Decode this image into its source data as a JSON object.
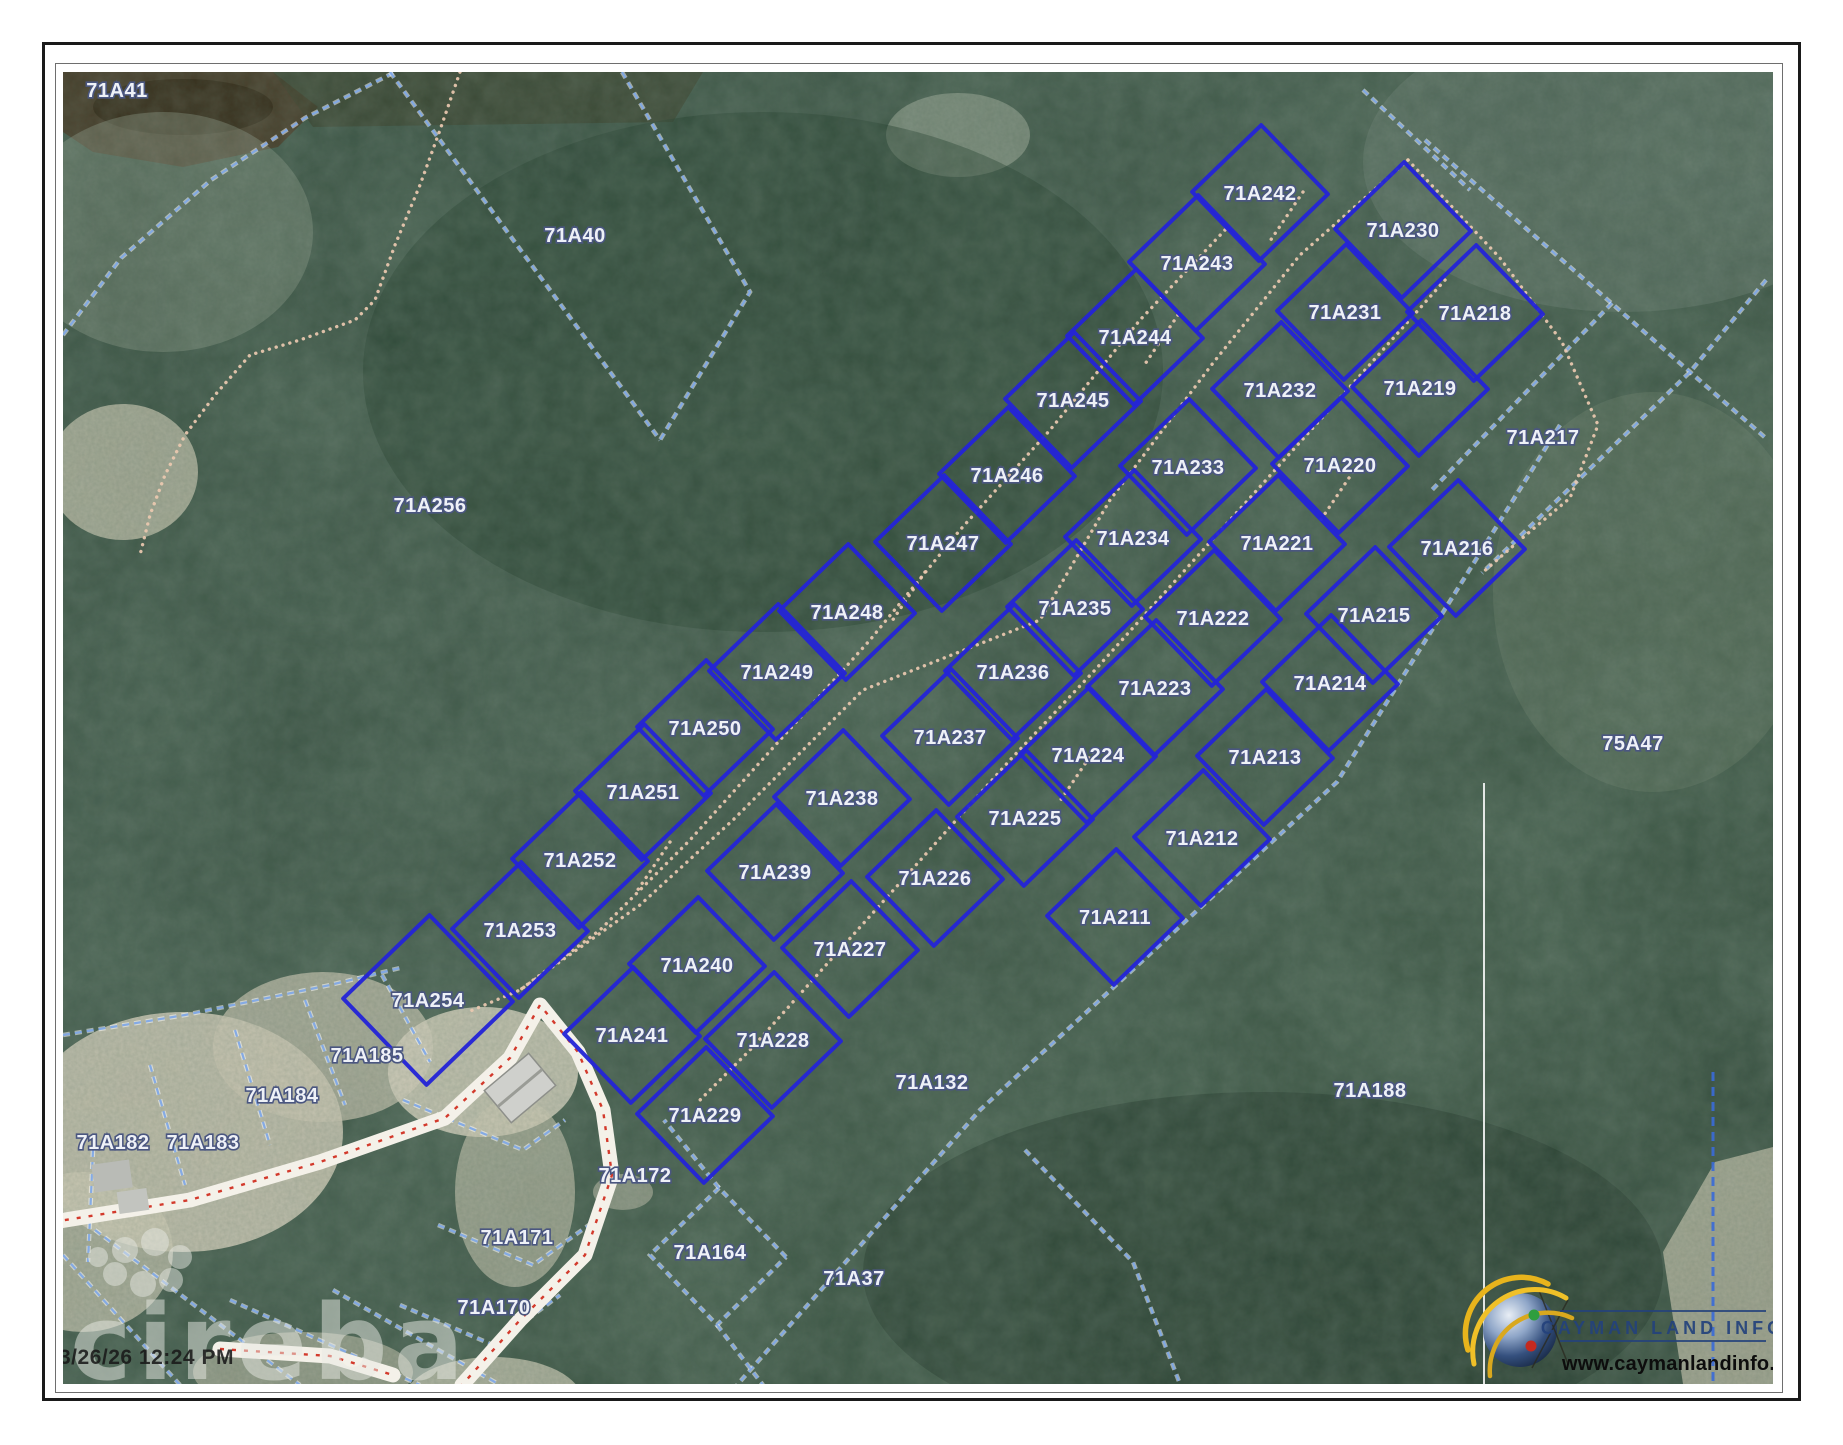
{
  "map": {
    "width": 1710,
    "height": 1312,
    "timestamp": "3/26/26 12:24 PM",
    "watermark": "cireba",
    "logo": {
      "title": "CAYMAN LAND INFO",
      "url": "www.caymanlandinfo.ky"
    },
    "colors": {
      "parcel_blue": "#2424d6",
      "boundary_blue": "#7fa8e6",
      "trail_tan": "#ecc9b0",
      "road_red": "#cf2617",
      "road_white": "#f4f1e9",
      "label_fill": "#eef1f7",
      "label_stroke": "#4a5680",
      "logo_navy": "#24427c",
      "forest_dark": "#2c4336",
      "sand": "#d2cdb8"
    },
    "parcels": [
      {
        "id": "71A242",
        "x": 1197,
        "y": 121
      },
      {
        "id": "71A243",
        "x": 1134,
        "y": 191
      },
      {
        "id": "71A244",
        "x": 1072,
        "y": 265
      },
      {
        "id": "71A245",
        "x": 1010,
        "y": 328
      },
      {
        "id": "71A246",
        "x": 944,
        "y": 403
      },
      {
        "id": "71A247",
        "x": 880,
        "y": 471
      },
      {
        "id": "71A248",
        "x": 784,
        "y": 540
      },
      {
        "id": "71A249",
        "x": 714,
        "y": 600
      },
      {
        "id": "71A250",
        "x": 642,
        "y": 656
      },
      {
        "id": "71A251",
        "x": 580,
        "y": 720
      },
      {
        "id": "71A252",
        "x": 517,
        "y": 788
      },
      {
        "id": "71A253",
        "x": 457,
        "y": 858
      },
      {
        "id": "71A254",
        "x": 365,
        "y": 928,
        "s": 120
      },
      {
        "id": "71A233",
        "x": 1125,
        "y": 395
      },
      {
        "id": "71A234",
        "x": 1070,
        "y": 466
      },
      {
        "id": "71A235",
        "x": 1012,
        "y": 536
      },
      {
        "id": "71A236",
        "x": 950,
        "y": 600
      },
      {
        "id": "71A237",
        "x": 887,
        "y": 665
      },
      {
        "id": "71A238",
        "x": 779,
        "y": 726
      },
      {
        "id": "71A239",
        "x": 712,
        "y": 800
      },
      {
        "id": "71A240",
        "x": 634,
        "y": 893
      },
      {
        "id": "71A241",
        "x": 569,
        "y": 963
      },
      {
        "id": "71A230",
        "x": 1340,
        "y": 158
      },
      {
        "id": "71A231",
        "x": 1282,
        "y": 240
      },
      {
        "id": "71A232",
        "x": 1217,
        "y": 318
      },
      {
        "id": "71A218",
        "x": 1412,
        "y": 241
      },
      {
        "id": "71A219",
        "x": 1357,
        "y": 316
      },
      {
        "id": "71A220",
        "x": 1277,
        "y": 393
      },
      {
        "id": "71A221",
        "x": 1214,
        "y": 471
      },
      {
        "id": "71A222",
        "x": 1150,
        "y": 546
      },
      {
        "id": "71A223",
        "x": 1092,
        "y": 616
      },
      {
        "id": "71A224",
        "x": 1025,
        "y": 683
      },
      {
        "id": "71A225",
        "x": 962,
        "y": 746
      },
      {
        "id": "71A226",
        "x": 872,
        "y": 806
      },
      {
        "id": "71A227",
        "x": 787,
        "y": 877
      },
      {
        "id": "71A228",
        "x": 710,
        "y": 968
      },
      {
        "id": "71A229",
        "x": 642,
        "y": 1043
      },
      {
        "id": "71A216",
        "x": 1394,
        "y": 476
      },
      {
        "id": "71A215",
        "x": 1311,
        "y": 543
      },
      {
        "id": "71A214",
        "x": 1267,
        "y": 611
      },
      {
        "id": "71A213",
        "x": 1202,
        "y": 685
      },
      {
        "id": "71A212",
        "x": 1139,
        "y": 766
      },
      {
        "id": "71A211",
        "x": 1052,
        "y": 845
      }
    ],
    "area_labels": [
      {
        "id": "71A41",
        "x": 54,
        "y": 18
      },
      {
        "id": "71A40",
        "x": 512,
        "y": 163
      },
      {
        "id": "71A256",
        "x": 367,
        "y": 433
      },
      {
        "id": "75A47",
        "x": 1570,
        "y": 671
      },
      {
        "id": "71A188",
        "x": 1307,
        "y": 1018
      },
      {
        "id": "71A132",
        "x": 869,
        "y": 1010
      },
      {
        "id": "71A37",
        "x": 791,
        "y": 1206
      },
      {
        "id": "71A185",
        "x": 304,
        "y": 983
      },
      {
        "id": "71A184",
        "x": 219,
        "y": 1023
      },
      {
        "id": "71A183",
        "x": 140,
        "y": 1070
      },
      {
        "id": "71A182",
        "x": 50,
        "y": 1070
      },
      {
        "id": "71A172",
        "x": 572,
        "y": 1103
      },
      {
        "id": "71A171",
        "x": 454,
        "y": 1165
      },
      {
        "id": "71A170",
        "x": 431,
        "y": 1235
      },
      {
        "id": "71A164",
        "x": 647,
        "y": 1180
      },
      {
        "id": "71A217",
        "x": 1480,
        "y": 365
      }
    ],
    "boundary_lines": [
      {
        "name": "71A41-arc",
        "pts": [
          [
            0,
            263
          ],
          [
            58,
            186
          ],
          [
            148,
            108
          ],
          [
            242,
            46
          ],
          [
            332,
            0
          ]
        ]
      },
      {
        "name": "71A40-west",
        "pts": [
          [
            327,
            0
          ],
          [
            597,
            368
          ]
        ]
      },
      {
        "name": "71A40-east",
        "pts": [
          [
            559,
            0
          ],
          [
            687,
            220
          ],
          [
            597,
            368
          ]
        ]
      },
      {
        "name": "ne-diagonal",
        "pts": [
          [
            1362,
            68
          ],
          [
            1627,
            300
          ],
          [
            1705,
            368
          ]
        ]
      },
      {
        "name": "ne-cross",
        "pts": [
          [
            1703,
            208
          ],
          [
            1627,
            300
          ],
          [
            1419,
            501
          ]
        ]
      },
      {
        "name": "217-ne-edge",
        "pts": [
          [
            1549,
            231
          ],
          [
            1367,
            420
          ]
        ]
      },
      {
        "name": "subdivision-se-boundary",
        "pts": [
          [
            1497,
            353
          ],
          [
            1274,
            710
          ],
          [
            917,
            1038
          ],
          [
            674,
            1313
          ]
        ]
      },
      {
        "name": "132-188-divider",
        "pts": [
          [
            962,
            1078
          ],
          [
            1070,
            1190
          ],
          [
            1117,
            1312
          ]
        ]
      },
      {
        "name": "ne-230-edge",
        "pts": [
          [
            1300,
            18
          ],
          [
            1407,
            118
          ]
        ]
      },
      {
        "name": "sw-lots-north",
        "pts": [
          [
            0,
            963
          ],
          [
            122,
            943
          ],
          [
            267,
            913
          ],
          [
            337,
            896
          ]
        ]
      },
      {
        "name": "182-183-divider",
        "pts": [
          [
            87,
            993
          ],
          [
            122,
            1113
          ]
        ]
      },
      {
        "name": "183-184-divider",
        "pts": [
          [
            172,
            958
          ],
          [
            207,
            1073
          ]
        ]
      },
      {
        "name": "184-185-divider",
        "pts": [
          [
            242,
            928
          ],
          [
            282,
            1033
          ]
        ]
      },
      {
        "name": "185-east-edge",
        "pts": [
          [
            319,
            903
          ],
          [
            367,
            990
          ]
        ]
      },
      {
        "name": "sw-corner-1",
        "pts": [
          [
            0,
            1183
          ],
          [
            117,
            1313
          ]
        ]
      },
      {
        "name": "sw-corner-2",
        "pts": [
          [
            32,
            1158
          ],
          [
            237,
            1313
          ]
        ]
      },
      {
        "name": "sw-corner-3",
        "pts": [
          [
            167,
            1228
          ],
          [
            357,
            1313
          ]
        ]
      },
      {
        "name": "sw-corner-4",
        "pts": [
          [
            270,
            1218
          ],
          [
            437,
            1313
          ]
        ]
      },
      {
        "name": "172-edges",
        "pts": [
          [
            340,
            1028
          ],
          [
            460,
            1078
          ],
          [
            502,
            1048
          ]
        ]
      },
      {
        "name": "171-edges",
        "pts": [
          [
            375,
            1153
          ],
          [
            470,
            1193
          ],
          [
            540,
            1143
          ]
        ]
      },
      {
        "name": "170-edges",
        "pts": [
          [
            337,
            1233
          ],
          [
            430,
            1273
          ],
          [
            497,
            1223
          ]
        ]
      },
      {
        "name": "164-parcel",
        "pts": [
          [
            723,
            1185
          ],
          [
            656,
            1116
          ],
          [
            587,
            1183
          ],
          [
            654,
            1253
          ],
          [
            723,
            1185
          ]
        ]
      },
      {
        "name": "37-west-edge",
        "pts": [
          [
            654,
            1253
          ],
          [
            700,
            1313
          ]
        ]
      },
      {
        "name": "164-north-tie",
        "pts": [
          [
            656,
            1116
          ],
          [
            601,
            1048
          ]
        ]
      },
      {
        "name": "left-edge-divider",
        "pts": [
          [
            30,
            1078
          ],
          [
            25,
            1190
          ]
        ]
      }
    ],
    "trails": [
      {
        "name": "central-track",
        "pts": [
          [
            1345,
            88
          ],
          [
            1237,
            183
          ],
          [
            1150,
            291
          ],
          [
            1047,
            428
          ],
          [
            977,
            548
          ],
          [
            800,
            618
          ],
          [
            670,
            748
          ],
          [
            577,
            833
          ],
          [
            457,
            918
          ],
          [
            405,
            940
          ]
        ]
      },
      {
        "name": "ne-branch-track",
        "pts": [
          [
            1345,
            88
          ],
          [
            1437,
            186
          ],
          [
            1499,
            270
          ],
          [
            1535,
            353
          ],
          [
            1507,
            426
          ],
          [
            1457,
            468
          ],
          [
            1419,
            501
          ]
        ]
      },
      {
        "name": "northwest-trail",
        "pts": [
          [
            397,
            0
          ],
          [
            377,
            58
          ],
          [
            357,
            113
          ],
          [
            332,
            173
          ],
          [
            312,
            228
          ],
          [
            292,
            248
          ],
          [
            237,
            268
          ],
          [
            187,
            283
          ],
          [
            152,
            323
          ],
          [
            122,
            363
          ],
          [
            102,
            403
          ],
          [
            87,
            443
          ],
          [
            77,
            483
          ]
        ]
      },
      {
        "name": "block1-interior",
        "pts": [
          [
            1162,
            158
          ],
          [
            1077,
            248
          ],
          [
            987,
            358
          ],
          [
            897,
            458
          ],
          [
            807,
            568
          ],
          [
            717,
            668
          ],
          [
            627,
            768
          ],
          [
            537,
            858
          ],
          [
            457,
            918
          ]
        ]
      },
      {
        "name": "block2-interior",
        "pts": [
          [
            1382,
            208
          ],
          [
            1302,
            298
          ],
          [
            1212,
            398
          ],
          [
            1122,
            498
          ],
          [
            1032,
            598
          ],
          [
            947,
            688
          ],
          [
            862,
            783
          ],
          [
            772,
            883
          ],
          [
            687,
            978
          ],
          [
            637,
            1028
          ]
        ]
      },
      {
        "name": "stub-1",
        "pts": [
          [
            1240,
            120
          ],
          [
            1205,
            172
          ]
        ]
      },
      {
        "name": "stub-2",
        "pts": [
          [
            1115,
            243
          ],
          [
            1080,
            295
          ]
        ]
      },
      {
        "name": "stub-3",
        "pts": [
          [
            862,
            500
          ],
          [
            827,
            552
          ]
        ]
      },
      {
        "name": "stub-4",
        "pts": [
          [
            1290,
            400
          ],
          [
            1255,
            452
          ]
        ]
      },
      {
        "name": "stub-5",
        "pts": [
          [
            1030,
            680
          ],
          [
            995,
            732
          ]
        ]
      },
      {
        "name": "stub-6",
        "pts": [
          [
            607,
            770
          ],
          [
            572,
            822
          ]
        ]
      }
    ],
    "roads": [
      {
        "name": "main-road",
        "pts": [
          [
            -10,
            1150
          ],
          [
            127,
            1128
          ],
          [
            257,
            1090
          ],
          [
            382,
            1046
          ],
          [
            447,
            986
          ],
          [
            477,
            933
          ],
          [
            515,
            980
          ],
          [
            540,
            1038
          ],
          [
            549,
            1103
          ],
          [
            522,
            1183
          ],
          [
            457,
            1248
          ],
          [
            399,
            1313
          ]
        ]
      },
      {
        "name": "road-spur",
        "pts": [
          [
            157,
            1277
          ],
          [
            267,
            1284
          ],
          [
            330,
            1303
          ]
        ]
      }
    ]
  }
}
